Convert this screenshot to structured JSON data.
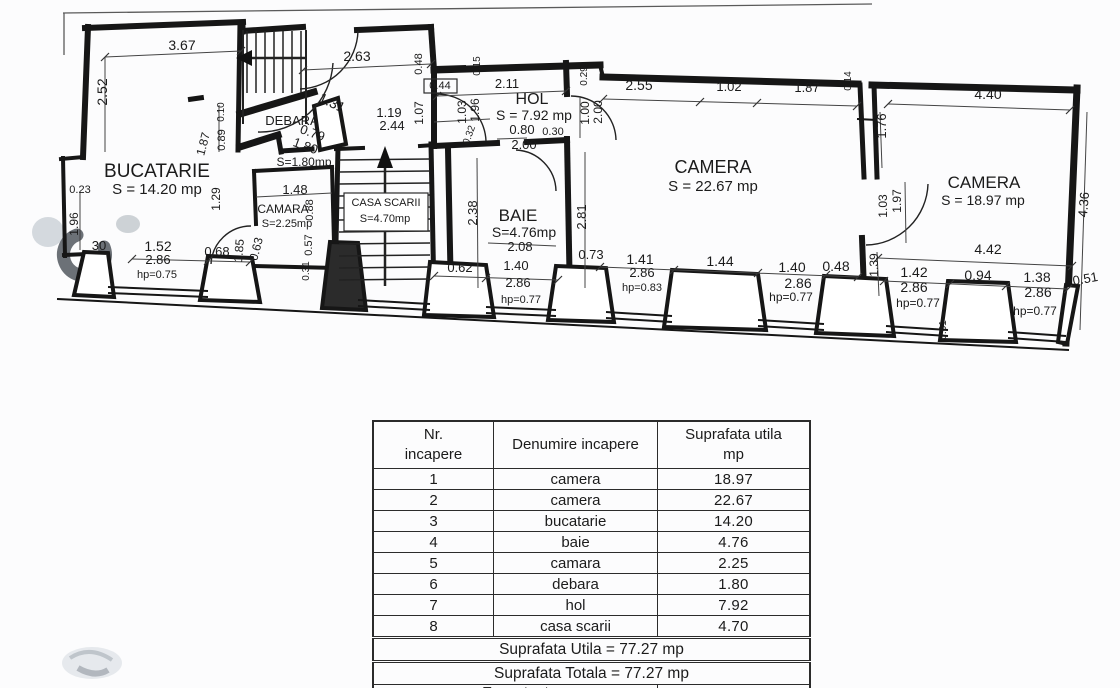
{
  "plan": {
    "labels": [
      {
        "n": "room-label-bucatarie",
        "t": "BUCATARIE",
        "x": 157,
        "y": 177,
        "s": 19
      },
      {
        "n": "room-area-bucatarie",
        "t": "S = 14.20 mp",
        "x": 157,
        "y": 194,
        "s": 15
      },
      {
        "n": "room-label-hol",
        "t": "HOL",
        "x": 532,
        "y": 104,
        "s": 16
      },
      {
        "n": "room-area-hol",
        "t": "S = 7.92 mp",
        "x": 534,
        "y": 120,
        "s": 14
      },
      {
        "n": "room-label-camera-1",
        "t": "CAMERA",
        "x": 713,
        "y": 173,
        "s": 18
      },
      {
        "n": "room-area-camera-1",
        "t": "S = 22.67 mp",
        "x": 713,
        "y": 191,
        "s": 15
      },
      {
        "n": "room-label-camera-2",
        "t": "CAMERA",
        "x": 984,
        "y": 188,
        "s": 17
      },
      {
        "n": "room-area-camera-2",
        "t": "S = 18.97 mp",
        "x": 983,
        "y": 205,
        "s": 14
      },
      {
        "n": "room-label-baie",
        "t": "BAIE",
        "x": 518,
        "y": 221,
        "s": 17
      },
      {
        "n": "room-area-baie",
        "t": "S=4.76mp",
        "x": 524,
        "y": 237,
        "s": 14
      },
      {
        "n": "room-label-camara",
        "t": "CAMARA",
        "x": 283,
        "y": 213,
        "s": 12
      },
      {
        "n": "room-area-camara",
        "t": "S=2.25mp",
        "x": 287,
        "y": 227,
        "s": 11
      },
      {
        "n": "room-label-debara",
        "t": "DEBARA",
        "x": 292,
        "y": 125,
        "s": 13
      },
      {
        "n": "room-area-debara",
        "t": "S=1.80mp",
        "x": 304,
        "y": 166,
        "s": 12
      },
      {
        "n": "room-label-casa-scarii",
        "t": "CASA SCARII",
        "x": 386,
        "y": 206,
        "s": 11
      },
      {
        "n": "room-area-casa-scarii",
        "t": "S=4.70mp",
        "x": 385,
        "y": 222,
        "s": 11
      },
      {
        "n": "dim-label",
        "t": "3.67",
        "x": 182,
        "y": 50,
        "s": 14
      },
      {
        "n": "dim-label",
        "t": "2.52",
        "x": 107,
        "y": 92,
        "s": 14,
        "r": -90
      },
      {
        "n": "dim-label",
        "t": "2.63",
        "x": 357,
        "y": 61,
        "s": 14
      },
      {
        "n": "dim-label",
        "t": "0.48",
        "x": 422,
        "y": 64,
        "s": 11,
        "r": -90
      },
      {
        "n": "dim-label",
        "t": "0.44",
        "x": 440,
        "y": 89,
        "s": 11
      },
      {
        "n": "dim-label",
        "t": "2.11",
        "x": 507,
        "y": 88,
        "s": 13
      },
      {
        "n": "dim-label",
        "t": "0.15",
        "x": 480,
        "y": 66,
        "s": 10,
        "r": -90
      },
      {
        "n": "dim-label",
        "t": "0.29",
        "x": 587,
        "y": 76,
        "s": 10,
        "r": -90
      },
      {
        "n": "dim-label",
        "t": "2.55",
        "x": 639,
        "y": 90,
        "s": 14
      },
      {
        "n": "dim-label",
        "t": "1.02",
        "x": 729,
        "y": 91,
        "s": 13
      },
      {
        "n": "dim-label",
        "t": "1.87",
        "x": 807,
        "y": 92,
        "s": 13
      },
      {
        "n": "dim-label",
        "t": "0.14",
        "x": 851,
        "y": 81,
        "s": 10,
        "r": -90
      },
      {
        "n": "dim-label",
        "t": "4.40",
        "x": 988,
        "y": 99,
        "s": 14
      },
      {
        "n": "dim-label",
        "t": "1.76",
        "x": 886,
        "y": 126,
        "s": 13,
        "r": -90
      },
      {
        "n": "dim-label",
        "t": "1.31",
        "x": 330,
        "y": 107,
        "s": 14,
        "r": 25
      },
      {
        "n": "dim-label",
        "t": "1.19",
        "x": 389,
        "y": 117,
        "s": 13
      },
      {
        "n": "dim-label",
        "t": "2.44",
        "x": 392,
        "y": 130,
        "s": 13
      },
      {
        "n": "dim-label",
        "t": "1.07",
        "x": 423,
        "y": 113,
        "s": 12,
        "r": -90
      },
      {
        "n": "dim-label",
        "t": "0.79",
        "x": 311,
        "y": 137,
        "s": 13,
        "r": 20
      },
      {
        "n": "dim-label",
        "t": "1.80",
        "x": 304,
        "y": 150,
        "s": 13,
        "r": 20
      },
      {
        "n": "dim-label",
        "t": "0.10",
        "x": 224,
        "y": 112,
        "s": 10,
        "r": -90
      },
      {
        "n": "dim-label",
        "t": "0.89",
        "x": 225,
        "y": 140,
        "s": 11,
        "r": -90
      },
      {
        "n": "dim-label",
        "t": "1.87",
        "x": 207,
        "y": 145,
        "s": 12,
        "r": -75
      },
      {
        "n": "dim-label",
        "t": "1.03",
        "x": 466,
        "y": 112,
        "s": 12,
        "r": -90
      },
      {
        "n": "dim-label",
        "t": "1.96",
        "x": 479,
        "y": 110,
        "s": 12,
        "r": -90
      },
      {
        "n": "dim-label",
        "t": "0.32",
        "x": 472,
        "y": 136,
        "s": 10,
        "r": -70
      },
      {
        "n": "dim-label",
        "t": "0.80",
        "x": 522,
        "y": 134,
        "s": 13
      },
      {
        "n": "dim-label",
        "t": "0.30",
        "x": 553,
        "y": 135,
        "s": 11
      },
      {
        "n": "dim-label",
        "t": "2.00",
        "x": 524,
        "y": 149,
        "s": 13
      },
      {
        "n": "dim-label",
        "t": "1.00",
        "x": 589,
        "y": 113,
        "s": 12,
        "r": -90
      },
      {
        "n": "dim-label",
        "t": "2.00",
        "x": 602,
        "y": 112,
        "s": 12,
        "r": -90
      },
      {
        "n": "dim-label",
        "t": "2.81",
        "x": 586,
        "y": 217,
        "s": 13,
        "r": -90
      },
      {
        "n": "dim-label",
        "t": "1.03",
        "x": 887,
        "y": 206,
        "s": 12,
        "r": -90
      },
      {
        "n": "dim-label",
        "t": "1.97",
        "x": 901,
        "y": 201,
        "s": 12,
        "r": -90
      },
      {
        "n": "dim-label",
        "t": "4.36",
        "x": 1088,
        "y": 205,
        "s": 13,
        "r": -85
      },
      {
        "n": "dim-label",
        "t": "0.23",
        "x": 80,
        "y": 193,
        "s": 11
      },
      {
        "n": "dim-label",
        "t": "1.96",
        "x": 78,
        "y": 224,
        "s": 12,
        "r": -90
      },
      {
        "n": "dim-label",
        "t": "1.29",
        "x": 220,
        "y": 199,
        "s": 12,
        "r": -90
      },
      {
        "n": "dim-label",
        "t": "1.48",
        "x": 295,
        "y": 194,
        "s": 13
      },
      {
        "n": "dim-label",
        "t": "0.88",
        "x": 313,
        "y": 210,
        "s": 11,
        "r": -90
      },
      {
        "n": "dim-label",
        "t": "0.57",
        "x": 312,
        "y": 245,
        "s": 11,
        "r": -90
      },
      {
        "n": "dim-label",
        "t": "0.31",
        "x": 309,
        "y": 271,
        "s": 10,
        "r": -90
      },
      {
        "n": "dim-label",
        "t": "2.38",
        "x": 477,
        "y": 213,
        "s": 13,
        "r": -90
      },
      {
        "n": "dim-label",
        "t": "2.08",
        "x": 520,
        "y": 251,
        "s": 13
      },
      {
        "n": "dim-label",
        "t": "30",
        "x": 99,
        "y": 250,
        "s": 13
      },
      {
        "n": "dim-label",
        "t": "1.52",
        "x": 158,
        "y": 251,
        "s": 14
      },
      {
        "n": "dim-label",
        "t": "2.86",
        "x": 158,
        "y": 264,
        "s": 13
      },
      {
        "n": "dim-label",
        "t": "hp=0.75",
        "x": 157,
        "y": 278,
        "s": 11
      },
      {
        "n": "dim-label",
        "t": "0.68",
        "x": 217,
        "y": 256,
        "s": 13
      },
      {
        "n": "dim-label",
        "t": "1.85",
        "x": 243,
        "y": 251,
        "s": 12,
        "r": -85
      },
      {
        "n": "dim-label",
        "t": "0.63",
        "x": 260,
        "y": 250,
        "s": 12,
        "r": -75
      },
      {
        "n": "dim-label",
        "t": "0.62",
        "x": 460,
        "y": 272,
        "s": 13
      },
      {
        "n": "dim-label",
        "t": "1.40",
        "x": 516,
        "y": 270,
        "s": 13
      },
      {
        "n": "dim-label",
        "t": "2.86",
        "x": 518,
        "y": 287,
        "s": 13
      },
      {
        "n": "dim-label",
        "t": "hp=0.77",
        "x": 521,
        "y": 303,
        "s": 11
      },
      {
        "n": "dim-label",
        "t": "0.73",
        "x": 591,
        "y": 259,
        "s": 13
      },
      {
        "n": "dim-label",
        "t": "1.41",
        "x": 640,
        "y": 264,
        "s": 14
      },
      {
        "n": "dim-label",
        "t": "2.86",
        "x": 642,
        "y": 277,
        "s": 13
      },
      {
        "n": "dim-label",
        "t": "hp=0.83",
        "x": 642,
        "y": 291,
        "s": 11
      },
      {
        "n": "dim-label",
        "t": "1.44",
        "x": 720,
        "y": 266,
        "s": 14
      },
      {
        "n": "dim-label",
        "t": "1.40",
        "x": 792,
        "y": 272,
        "s": 14
      },
      {
        "n": "dim-label",
        "t": "2.86",
        "x": 798,
        "y": 288,
        "s": 14
      },
      {
        "n": "dim-label",
        "t": "hp=0.77",
        "x": 791,
        "y": 301,
        "s": 12
      },
      {
        "n": "dim-label",
        "t": "0.48",
        "x": 836,
        "y": 271,
        "s": 14
      },
      {
        "n": "dim-label",
        "t": "1.39",
        "x": 878,
        "y": 265,
        "s": 12,
        "r": -90
      },
      {
        "n": "dim-label",
        "t": "4.42",
        "x": 988,
        "y": 254,
        "s": 14
      },
      {
        "n": "dim-label",
        "t": "1.42",
        "x": 914,
        "y": 277,
        "s": 14
      },
      {
        "n": "dim-label",
        "t": "2.86",
        "x": 914,
        "y": 292,
        "s": 14
      },
      {
        "n": "dim-label",
        "t": "hp=0.77",
        "x": 918,
        "y": 307,
        "s": 12
      },
      {
        "n": "dim-label",
        "t": "0.94",
        "x": 978,
        "y": 280,
        "s": 14
      },
      {
        "n": "dim-label",
        "t": "1.38",
        "x": 1037,
        "y": 282,
        "s": 14
      },
      {
        "n": "dim-label",
        "t": "2.86",
        "x": 1038,
        "y": 297,
        "s": 14
      },
      {
        "n": "dim-label",
        "t": "hp=0.77",
        "x": 1035,
        "y": 315,
        "s": 12
      },
      {
        "n": "dim-label",
        "t": "0.51",
        "x": 1086,
        "y": 283,
        "s": 13,
        "r": -10
      },
      {
        "n": "dim-label",
        "t": "0.61",
        "x": 946,
        "y": 330,
        "s": 10,
        "r": -90
      }
    ]
  },
  "table": {
    "headers": [
      [
        "Nr.",
        "incapere"
      ],
      [
        "Denumire incapere"
      ],
      [
        "Suprafata utila",
        "mp"
      ]
    ],
    "rows": [
      [
        "1",
        "camera",
        "18.97"
      ],
      [
        "2",
        "camera",
        "22.67"
      ],
      [
        "3",
        "bucatarie",
        "14.20"
      ],
      [
        "4",
        "baie",
        "4.76"
      ],
      [
        "5",
        "camara",
        "2.25"
      ],
      [
        "6",
        "debara",
        "1.80"
      ],
      [
        "7",
        "hol",
        "7.92"
      ],
      [
        "8",
        "casa scarii",
        "4.70"
      ]
    ],
    "footer_rows": [
      "Suprafata Utila = 77.27 mp",
      "Suprafata Totala = 77.27 mp"
    ],
    "partial_row": "Executant"
  }
}
